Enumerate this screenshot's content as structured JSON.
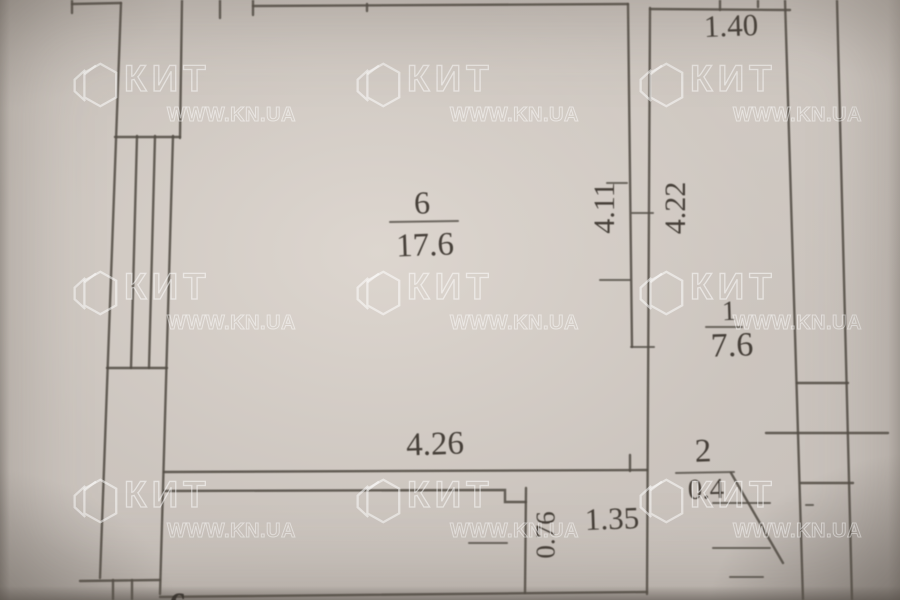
{
  "watermark": {
    "brand": "КИТ",
    "url": "WWW.KN.UA",
    "icon": "hexagon-logo-icon",
    "stroke_color": "#ffffff"
  },
  "floor_plan": {
    "paper_color": "#c9c2bc",
    "line_color": "#534d46",
    "rooms": [
      {
        "number": "6",
        "area": "17.6"
      },
      {
        "number": "1",
        "area": "7.6"
      },
      {
        "number": "2",
        "area": "0.4"
      }
    ],
    "dimensions": [
      {
        "label": "1.40",
        "orientation": "horizontal"
      },
      {
        "label": "4.11",
        "orientation": "vertical"
      },
      {
        "label": "4.22",
        "orientation": "vertical"
      },
      {
        "label": "4.26",
        "orientation": "horizontal"
      },
      {
        "label": "0.76",
        "orientation": "vertical"
      },
      {
        "label": "1.35",
        "orientation": "horizontal"
      }
    ],
    "partial_glyph": "6"
  }
}
